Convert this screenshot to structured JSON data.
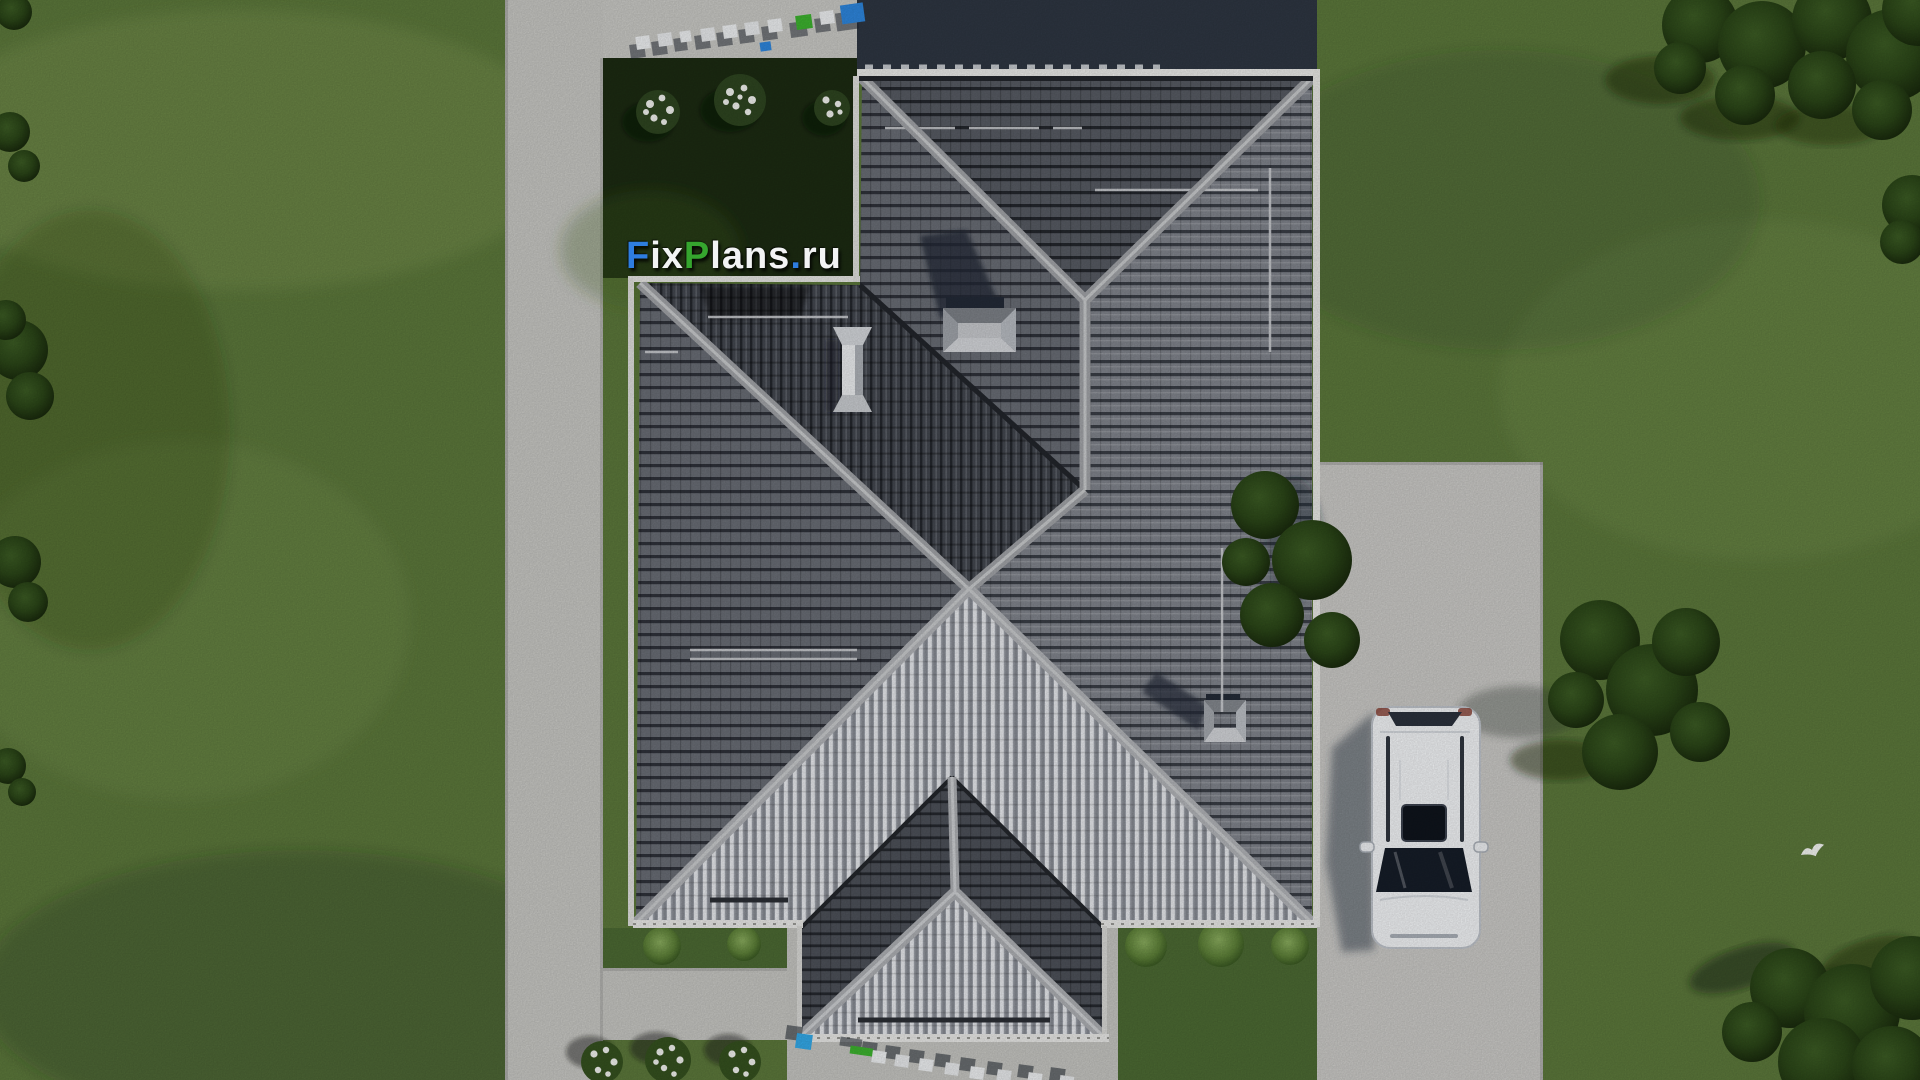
{
  "watermark": {
    "full_text": "FixPlans.ru",
    "logo": {
      "parts": [
        {
          "text": "F",
          "color": "#2e7de0",
          "style": "color:#2e7de0"
        },
        {
          "text": "ix",
          "color": "#f2f3f4",
          "style": "color:#f2f3f4"
        },
        {
          "text": "P",
          "color": "#35a52e",
          "style": "color:#35a52e"
        },
        {
          "text": "lans",
          "color": "#f2f3f4",
          "style": "color:#f2f3f4"
        },
        {
          "text": ".",
          "color": "#2e7de0",
          "style": "color:#2e7de0"
        },
        {
          "text": "ru",
          "color": "#f2f3f4",
          "style": "color:#f2f3f4"
        }
      ]
    }
  },
  "scene": {
    "colors": {
      "lawn": "#5c783b",
      "lawn_shadowed": "#1c2b12",
      "concrete": "#c8c8c4",
      "roof_north_slope": "#575b63",
      "roof_east_slope": "#7e828a",
      "roof_sunlit_slope": "#e4e6ea",
      "ridge_cap": "#a6a8ac",
      "house_shadow_band": "#2e3642",
      "car_body": "#f3f5f7",
      "tree_canopy": "#2c4719"
    }
  }
}
